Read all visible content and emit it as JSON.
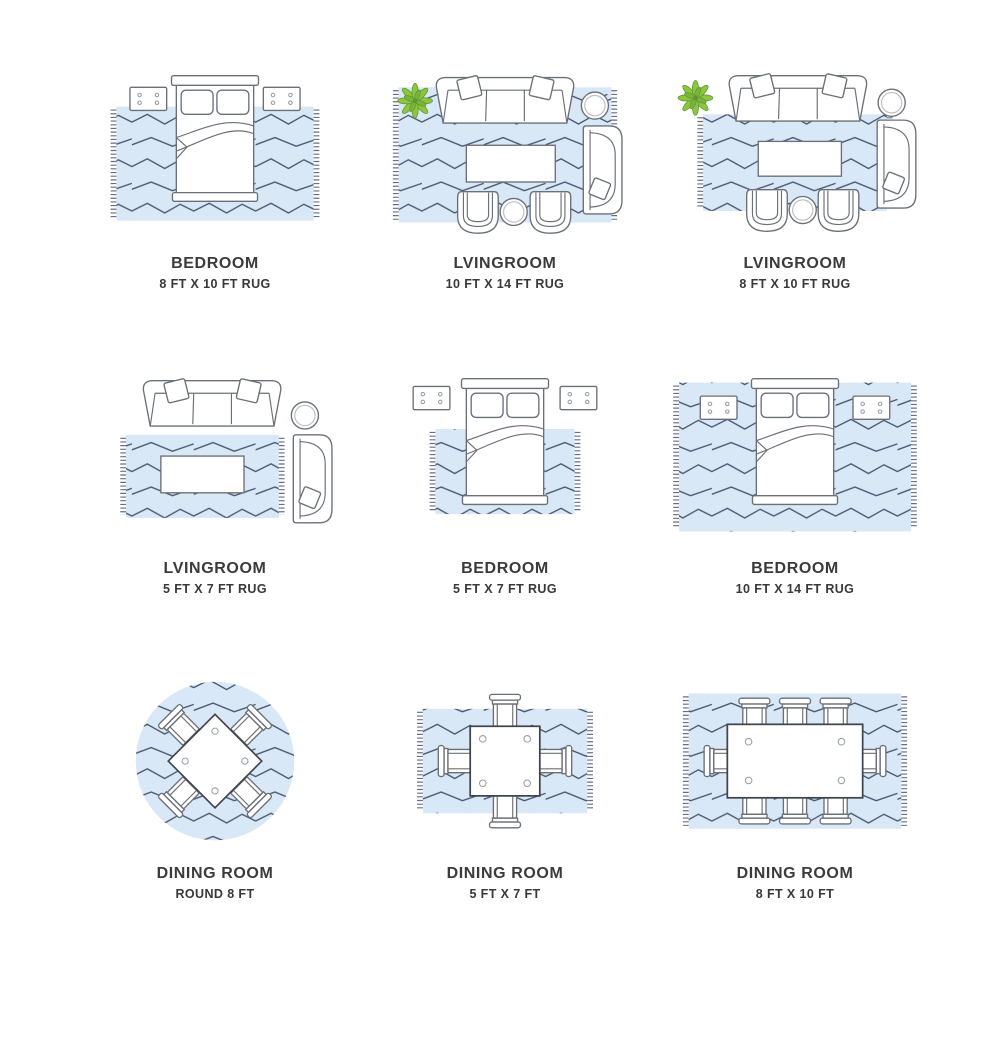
{
  "palette": {
    "background": "#ffffff",
    "rug_blue": "#d9e8f7",
    "pattern_navy": "#47566e",
    "furniture_stroke": "#6b7078",
    "plant_green": "#8cc63f",
    "text_color": "#3b3b3b"
  },
  "cells": [
    {
      "room": "BEDROOM",
      "size": "8 FT X 10 FT RUG",
      "scene": "bedroom-8x10",
      "furniture": [
        "bed",
        "nightstand",
        "nightstand",
        "rug"
      ]
    },
    {
      "room": "LVINGROOM",
      "size": "10 FT X 14 FT RUG",
      "scene": "livingroom-10x14",
      "furniture": [
        "sofa",
        "plant",
        "side-table",
        "chaise",
        "coffee-table",
        "armchair",
        "armchair",
        "round-table",
        "rug"
      ]
    },
    {
      "room": "LVINGROOM",
      "size": "8 FT X 10 FT RUG",
      "scene": "livingroom-8x10",
      "furniture": [
        "sofa",
        "plant",
        "side-table",
        "chaise",
        "coffee-table",
        "armchair",
        "armchair",
        "round-table",
        "rug"
      ]
    },
    {
      "room": "LVINGROOM",
      "size": "5 FT X 7 FT RUG",
      "scene": "livingroom-5x7",
      "furniture": [
        "sofa",
        "side-table",
        "chaise",
        "coffee-table",
        "rug"
      ]
    },
    {
      "room": "BEDROOM",
      "size": "5 FT X 7 FT RUG",
      "scene": "bedroom-5x7",
      "furniture": [
        "bed",
        "nightstand",
        "nightstand",
        "rug"
      ]
    },
    {
      "room": "BEDROOM",
      "size": "10 FT X 14 FT RUG",
      "scene": "bedroom-10x14",
      "furniture": [
        "bed",
        "nightstand",
        "nightstand",
        "rug"
      ]
    },
    {
      "room": "DINING ROOM",
      "size": "ROUND 8 FT",
      "scene": "dining-round-8",
      "furniture": [
        "square-table",
        "chair",
        "chair",
        "chair",
        "chair",
        "round-rug"
      ]
    },
    {
      "room": "DINING ROOM",
      "size": "5 FT X 7 FT",
      "scene": "dining-5x7",
      "furniture": [
        "square-table",
        "chair",
        "chair",
        "chair",
        "chair",
        "rug"
      ]
    },
    {
      "room": "DINING ROOM",
      "size": "8 FT X 10 FT",
      "scene": "dining-8x10",
      "furniture": [
        "rect-table",
        "chair",
        "chair",
        "chair",
        "chair",
        "chair",
        "chair",
        "chair",
        "chair",
        "rug"
      ]
    }
  ]
}
